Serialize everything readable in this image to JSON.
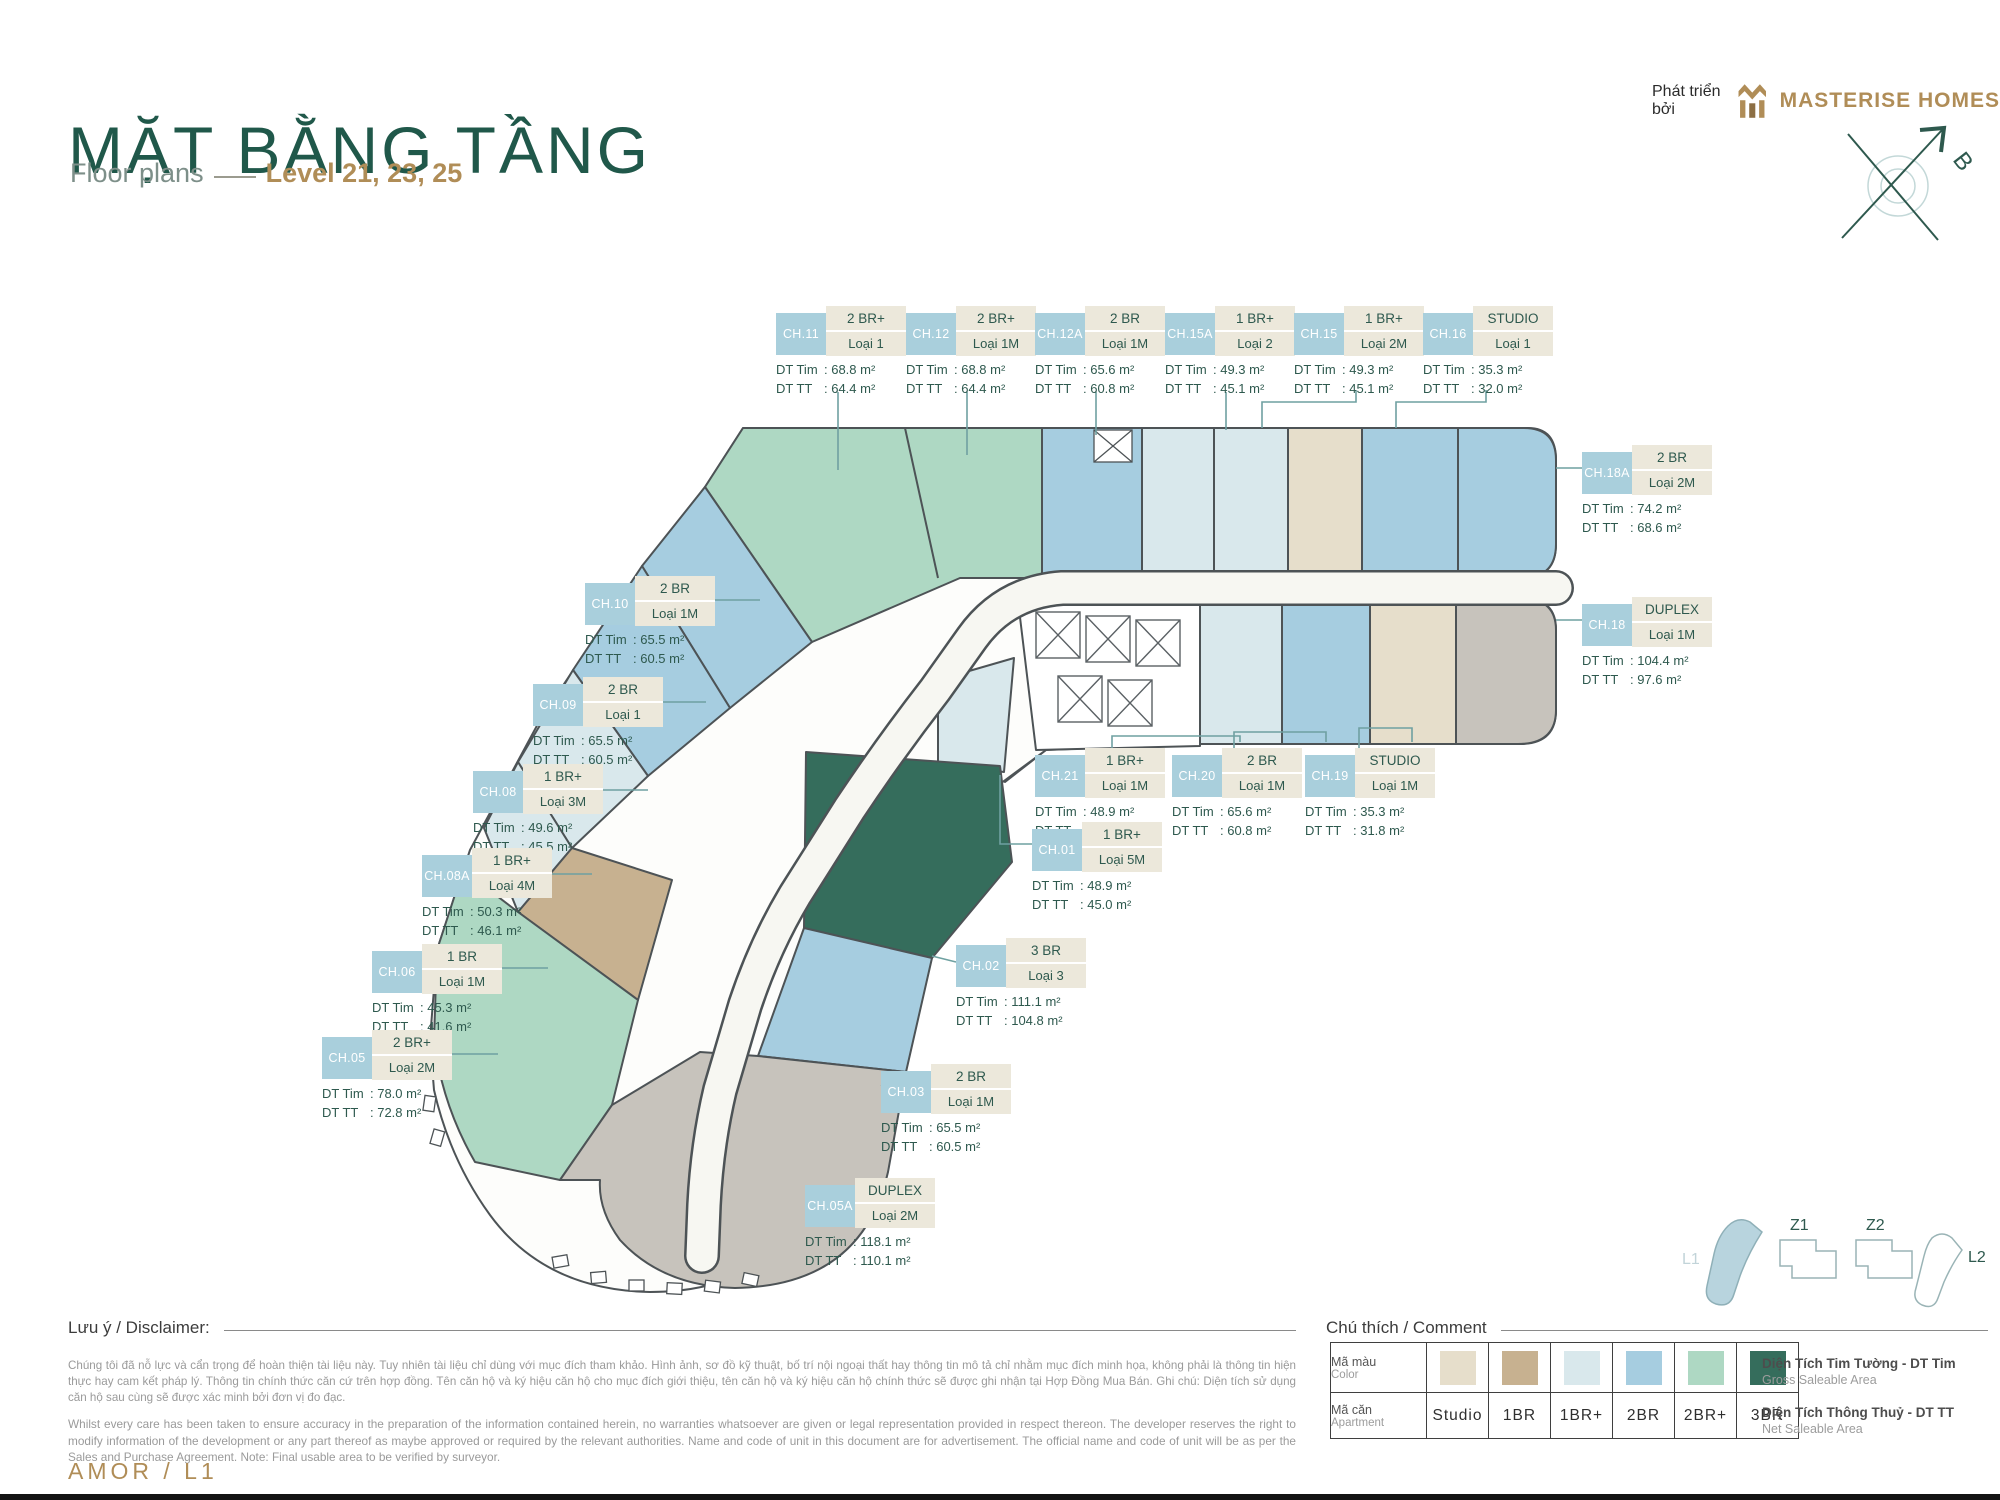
{
  "header": {
    "title": "MẶT BẰNG TẦNG",
    "subtitle": "Floor plans",
    "level": "Level 21, 23, 25",
    "developer_prefix": "Phát triển bởi",
    "developer": "MASTERISE HOMES",
    "compass_letter": "B"
  },
  "colors": {
    "title_green": "#20584a",
    "gold": "#b08d57",
    "callout_label_bg": "#a9cfdc",
    "callout_type_bg": "#ece8db",
    "area_green": "#2e594e",
    "leader_teal": "#6fa0a1",
    "studio": "#e6decb",
    "br1": "#c7b190",
    "br1_plus": "#d9e8ec",
    "br2": "#a6cde0",
    "br2_plus": "#aed8c3",
    "br3": "#356d5c",
    "duplex_gray": "#c7c3bc"
  },
  "area_labels": {
    "tim": "DT Tim",
    "tt": "DT TT",
    "unit": "m²"
  },
  "callouts": [
    {
      "id": "CH.11",
      "type": "2 BR+",
      "variant": "Loại 1",
      "tim": "68.8",
      "tt": "64.4",
      "x": 776,
      "y": 306
    },
    {
      "id": "CH.12",
      "type": "2 BR+",
      "variant": "Loại 1M",
      "tim": "68.8",
      "tt": "64.4",
      "x": 906,
      "y": 306
    },
    {
      "id": "CH.12A",
      "type": "2 BR",
      "variant": "Loại 1M",
      "tim": "65.6",
      "tt": "60.8",
      "x": 1035,
      "y": 306
    },
    {
      "id": "CH.15A",
      "type": "1 BR+",
      "variant": "Loại 2",
      "tim": "49.3",
      "tt": "45.1",
      "x": 1165,
      "y": 306
    },
    {
      "id": "CH.15",
      "type": "1 BR+",
      "variant": "Loại 2M",
      "tim": "49.3",
      "tt": "45.1",
      "x": 1294,
      "y": 306
    },
    {
      "id": "CH.16",
      "type": "STUDIO",
      "variant": "Loại 1",
      "tim": "35.3",
      "tt": "32.0",
      "x": 1423,
      "y": 306
    },
    {
      "id": "CH.18A",
      "type": "2 BR",
      "variant": "Loại 2M",
      "tim": "74.2",
      "tt": "68.6",
      "x": 1582,
      "y": 445
    },
    {
      "id": "CH.18",
      "type": "DUPLEX",
      "variant": "Loại 1M",
      "tim": "104.4",
      "tt": "97.6",
      "x": 1582,
      "y": 597
    },
    {
      "id": "CH.10",
      "type": "2 BR",
      "variant": "Loại 1M",
      "tim": "65.5",
      "tt": "60.5",
      "x": 585,
      "y": 576
    },
    {
      "id": "CH.09",
      "type": "2 BR",
      "variant": "Loại 1",
      "tim": "65.5",
      "tt": "60.5",
      "x": 533,
      "y": 677
    },
    {
      "id": "CH.08",
      "type": "1 BR+",
      "variant": "Loại 3M",
      "tim": "49.6",
      "tt": "45.5",
      "x": 473,
      "y": 764
    },
    {
      "id": "CH.08A",
      "type": "1 BR+",
      "variant": "Loại 4M",
      "tim": "50.3",
      "tt": "46.1",
      "x": 422,
      "y": 848
    },
    {
      "id": "CH.06",
      "type": "1 BR",
      "variant": "Loại 1M",
      "tim": "45.3",
      "tt": "41.6",
      "x": 372,
      "y": 944
    },
    {
      "id": "CH.05",
      "type": "2 BR+",
      "variant": "Loại 2M",
      "tim": "78.0",
      "tt": "72.8",
      "x": 322,
      "y": 1030
    },
    {
      "id": "CH.21",
      "type": "1 BR+",
      "variant": "Loại 1M",
      "tim": "48.9",
      "tt": "45.2",
      "x": 1035,
      "y": 748
    },
    {
      "id": "CH.20",
      "type": "2 BR",
      "variant": "Loại 1M",
      "tim": "65.6",
      "tt": "60.8",
      "x": 1172,
      "y": 748
    },
    {
      "id": "CH.19",
      "type": "STUDIO",
      "variant": "Loại 1M",
      "tim": "35.3",
      "tt": "31.8",
      "x": 1305,
      "y": 748
    },
    {
      "id": "CH.01",
      "type": "1 BR+",
      "variant": "Loại 5M",
      "tim": "48.9",
      "tt": "45.0",
      "x": 1032,
      "y": 822
    },
    {
      "id": "CH.02",
      "type": "3 BR",
      "variant": "Loại 3",
      "tim": "111.1",
      "tt": "104.8",
      "x": 956,
      "y": 938
    },
    {
      "id": "CH.03",
      "type": "2 BR",
      "variant": "Loại 1M",
      "tim": "65.5",
      "tt": "60.5",
      "x": 881,
      "y": 1064
    },
    {
      "id": "CH.05A",
      "type": "DUPLEX",
      "variant": "Loại 2M",
      "tim": "118.1",
      "tt": "110.1",
      "x": 805,
      "y": 1178
    }
  ],
  "disclaimer": {
    "heading": "Lưu ý / Disclaimer:",
    "vi": "Chúng tôi đã nỗ lực và cẩn trọng để hoàn thiện tài liệu này. Tuy nhiên tài liệu chỉ dùng với mục đích tham khảo. Hình ảnh, sơ đồ kỹ thuật, bố trí nội ngoại thất hay thông tin mô tả chỉ nhằm mục đích minh họa, không phải là thông tin hiện thực hay cam kết pháp lý. Thông tin chính thức căn cứ trên hợp đồng. Tên căn hộ và ký hiệu căn hộ cho mục đích giới thiệu, tên căn hộ và ký hiệu căn hộ chính thức sẽ được ghi nhận tại Hợp Đồng Mua Bán. Ghi chú: Diện tích sử dụng căn hộ sau cùng sẽ được xác minh bởi đơn vị đo đạc.",
    "en": "Whilst every care has been taken to ensure accuracy in the preparation of the information contained herein, no warranties whatsoever are given or legal representation provided in respect thereon. The developer reserves the right to modify information of the development or any part thereof as maybe approved or required by the relevant authorities. Name and code of unit in this document are for advertisement. The official name and code of unit will be as per the Sales and Purchase Agreement. Note: Final usable area to be verified by surveyor."
  },
  "legend": {
    "heading": "Chú thích / Comment",
    "color_row": {
      "vi": "Mã màu",
      "en": "Color"
    },
    "apartment_row": {
      "vi": "Mã căn",
      "en": "Apartment"
    },
    "items": [
      {
        "label": "Studio",
        "color": "#e6decb"
      },
      {
        "label": "1BR",
        "color": "#c7b190"
      },
      {
        "label": "1BR+",
        "color": "#d9e8ec"
      },
      {
        "label": "2BR",
        "color": "#a6cde0"
      },
      {
        "label": "2BR+",
        "color": "#aed8c3"
      },
      {
        "label": "3BR",
        "color": "#356d5c"
      }
    ],
    "area_defs": [
      {
        "vi": "Diện Tích Tim Tường - DT Tim",
        "en": "Gross Saleable Area"
      },
      {
        "vi": "Diện Tích Thông Thuỷ - DT TT",
        "en": "Net Saleable Area"
      }
    ]
  },
  "keyplan": {
    "l1": "L1",
    "z1": "Z1",
    "z2": "Z2",
    "l2": "L2"
  },
  "footer": {
    "code": "AMOR / L1"
  }
}
